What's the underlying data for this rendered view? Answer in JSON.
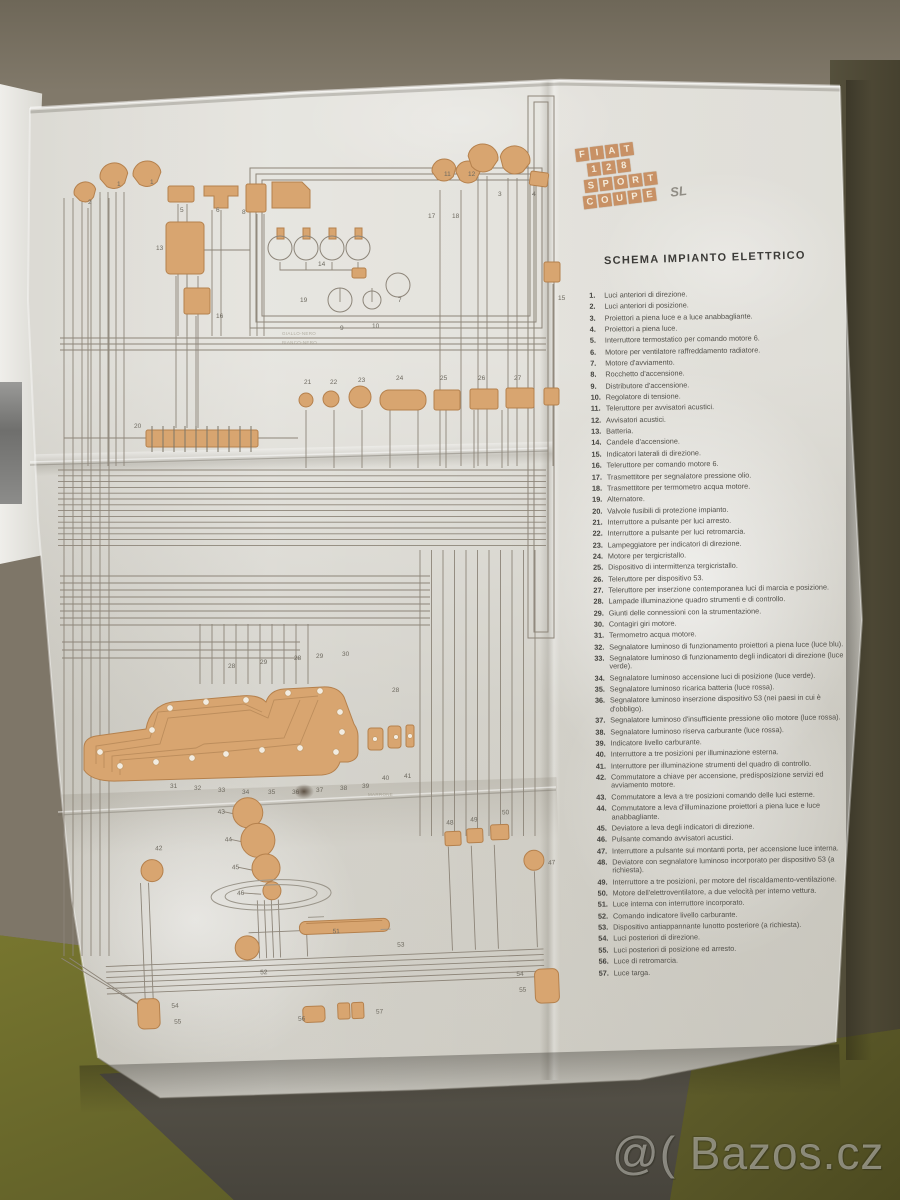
{
  "photo": {
    "watermark": "@( Bazos.cz"
  },
  "document": {
    "logo": {
      "rows": [
        "FIAT",
        "128",
        "SPORT",
        "COUPE"
      ],
      "suffix": "SL"
    },
    "title": "SCHEMA IMPIANTO ELETTRICO",
    "colors": {
      "component": "#d8a570",
      "component_stroke": "#b5814d",
      "wire": "#8d8579",
      "paper": "#d9d7cf",
      "logo_tile": "#c89165"
    },
    "legend_items": [
      {
        "n": "1.",
        "text": "Luci anteriori di direzione."
      },
      {
        "n": "2.",
        "text": "Luci anteriori di posizione."
      },
      {
        "n": "3.",
        "text": "Proiettori a piena luce e a luce anabbagliante."
      },
      {
        "n": "4.",
        "text": "Proiettori a piena luce."
      },
      {
        "n": "5.",
        "text": "Interruttore termostatico per comando motore 6."
      },
      {
        "n": "6.",
        "text": "Motore per ventilatore raffreddamento radiatore."
      },
      {
        "n": "7.",
        "text": "Motore d'avviamento."
      },
      {
        "n": "8.",
        "text": "Rocchetto d'accensione."
      },
      {
        "n": "9.",
        "text": "Distributore d'accensione."
      },
      {
        "n": "10.",
        "text": "Regolatore di tensione."
      },
      {
        "n": "11.",
        "text": "Teleruttore per avvisatori acustici."
      },
      {
        "n": "12.",
        "text": "Avvisatori acustici."
      },
      {
        "n": "13.",
        "text": "Batteria."
      },
      {
        "n": "14.",
        "text": "Candele d'accensione."
      },
      {
        "n": "15.",
        "text": "Indicatori laterali di direzione."
      },
      {
        "n": "16.",
        "text": "Teleruttore per comando motore 6."
      },
      {
        "n": "17.",
        "text": "Trasmettitore per segnalatore pressione olio."
      },
      {
        "n": "18.",
        "text": "Trasmettitore per termometro acqua motore."
      },
      {
        "n": "19.",
        "text": "Alternatore."
      },
      {
        "n": "20.",
        "text": "Valvole fusibili di protezione impianto."
      },
      {
        "n": "21.",
        "text": "Interruttore a pulsante per luci arresto."
      },
      {
        "n": "22.",
        "text": "Interruttore a pulsante per luci retromarcia."
      },
      {
        "n": "23.",
        "text": "Lampeggiatore per indicatori di direzione."
      },
      {
        "n": "24.",
        "text": "Motore per tergicristallo."
      },
      {
        "n": "25.",
        "text": "Dispositivo di intermittenza tergicristallo."
      },
      {
        "n": "26.",
        "text": "Teleruttore per dispositivo 53."
      },
      {
        "n": "27.",
        "text": "Teleruttore per inserzione contemporanea luci di marcia e posizione."
      },
      {
        "n": "28.",
        "text": "Lampade illuminazione quadro strumenti e di controllo."
      },
      {
        "n": "29.",
        "text": "Giunti delle connessioni con la strumentazione."
      },
      {
        "n": "30.",
        "text": "Contagiri giri motore."
      },
      {
        "n": "31.",
        "text": "Termometro acqua motore."
      },
      {
        "n": "32.",
        "text": "Segnalatore luminoso di funzionamento proiettori a piena luce (luce blu)."
      },
      {
        "n": "33.",
        "text": "Segnalatore luminoso di funzionamento degli indicatori di direzione (luce verde)."
      },
      {
        "n": "34.",
        "text": "Segnalatore luminoso accensione luci di posizione (luce verde)."
      },
      {
        "n": "35.",
        "text": "Segnalatore luminoso ricarica batteria (luce rossa)."
      },
      {
        "n": "36.",
        "text": "Segnalatore luminoso inserzione dispositivo 53 (nei paesi in cui è d'obbligo)."
      },
      {
        "n": "37.",
        "text": "Segnalatore luminoso d'insufficiente pressione olio motore (luce rossa)."
      },
      {
        "n": "38.",
        "text": "Segnalatore luminoso riserva carburante (luce rossa)."
      },
      {
        "n": "39.",
        "text": "Indicatore livello carburante."
      },
      {
        "n": "40.",
        "text": "Interruttore a tre posizioni per illuminazione esterna."
      },
      {
        "n": "41.",
        "text": "Interruttore per illuminazione strumenti del quadro di controllo."
      },
      {
        "n": "42.",
        "text": "Commutatore a chiave per accensione, predisposizione servizi ed avviamento motore."
      },
      {
        "n": "43.",
        "text": "Commutatore a leva a tre posizioni comando delle luci esterne."
      },
      {
        "n": "44.",
        "text": "Commutatore a leva d'illuminazione proiettori a piena luce e luce anabbagliante."
      },
      {
        "n": "45.",
        "text": "Deviatore a leva degli indicatori di direzione."
      },
      {
        "n": "46.",
        "text": "Pulsante comando avvisatori acustici."
      },
      {
        "n": "47.",
        "text": "Interruttore a pulsante sui montanti porta, per accensione luce interna."
      },
      {
        "n": "48.",
        "text": "Deviatore con segnalatore luminoso incorporato per dispositivo 53 (a richiesta)."
      },
      {
        "n": "49.",
        "text": "Interruttore a tre posizioni, per motore del riscaldamento-ventilazione."
      },
      {
        "n": "50.",
        "text": "Motore dell'elettroventilatore, a due velocità per interno vettura."
      },
      {
        "n": "51.",
        "text": "Luce interna con interruttore incorporato."
      },
      {
        "n": "52.",
        "text": "Comando indicatore livello carburante."
      },
      {
        "n": "53.",
        "text": "Dispositivo antiappannante lunotto posteriore (a richiesta)."
      },
      {
        "n": "54.",
        "text": "Luci posteriori di direzione."
      },
      {
        "n": "55.",
        "text": "Luci posteriori di posizione ed arresto."
      },
      {
        "n": "56.",
        "text": "Luce di retromarcia."
      },
      {
        "n": "57.",
        "text": "Luce targa."
      }
    ],
    "diagram_labels": [
      {
        "t": "1",
        "x": 117,
        "y": 186,
        "g": "t"
      },
      {
        "t": "1",
        "x": 150,
        "y": 184,
        "g": "t"
      },
      {
        "t": "2",
        "x": 88,
        "y": 204,
        "g": "t"
      },
      {
        "t": "5",
        "x": 180,
        "y": 212,
        "g": "t"
      },
      {
        "t": "6",
        "x": 216,
        "y": 212,
        "g": "t"
      },
      {
        "t": "13",
        "x": 156,
        "y": 250,
        "g": "t"
      },
      {
        "t": "16",
        "x": 216,
        "y": 318,
        "g": "t"
      },
      {
        "t": "8",
        "x": 242,
        "y": 214,
        "g": "t"
      },
      {
        "t": "14",
        "x": 318,
        "y": 266,
        "g": "t"
      },
      {
        "t": "9",
        "x": 340,
        "y": 330,
        "g": "t"
      },
      {
        "t": "10",
        "x": 372,
        "y": 328,
        "g": "t"
      },
      {
        "t": "11",
        "x": 444,
        "y": 176,
        "g": "t"
      },
      {
        "t": "12",
        "x": 468,
        "y": 176,
        "g": "t"
      },
      {
        "t": "3",
        "x": 498,
        "y": 196,
        "g": "t"
      },
      {
        "t": "4",
        "x": 532,
        "y": 196,
        "g": "t"
      },
      {
        "t": "7",
        "x": 398,
        "y": 302,
        "g": "t"
      },
      {
        "t": "19",
        "x": 300,
        "y": 302,
        "g": "t"
      },
      {
        "t": "15",
        "x": 558,
        "y": 300,
        "g": "t"
      },
      {
        "t": "17",
        "x": 428,
        "y": 218,
        "g": "t"
      },
      {
        "t": "18",
        "x": 452,
        "y": 218,
        "g": "t"
      },
      {
        "t": "20",
        "x": 134,
        "y": 428,
        "g": "t"
      },
      {
        "t": "21",
        "x": 304,
        "y": 384,
        "g": "t"
      },
      {
        "t": "22",
        "x": 330,
        "y": 384,
        "g": "t"
      },
      {
        "t": "23",
        "x": 358,
        "y": 382,
        "g": "t"
      },
      {
        "t": "24",
        "x": 396,
        "y": 380,
        "g": "t"
      },
      {
        "t": "25",
        "x": 440,
        "y": 380,
        "g": "t"
      },
      {
        "t": "26",
        "x": 478,
        "y": 380,
        "g": "t"
      },
      {
        "t": "27",
        "x": 514,
        "y": 380,
        "g": "t"
      },
      {
        "t": "28",
        "x": 228,
        "y": 668,
        "g": "t"
      },
      {
        "t": "29",
        "x": 260,
        "y": 664,
        "g": "t"
      },
      {
        "t": "28",
        "x": 294,
        "y": 660,
        "g": "t"
      },
      {
        "t": "29",
        "x": 316,
        "y": 658,
        "g": "t"
      },
      {
        "t": "30",
        "x": 342,
        "y": 656,
        "g": "t"
      },
      {
        "t": "28",
        "x": 392,
        "y": 692,
        "g": "t"
      },
      {
        "t": "31",
        "x": 170,
        "y": 788,
        "g": "t"
      },
      {
        "t": "32",
        "x": 194,
        "y": 790,
        "g": "t"
      },
      {
        "t": "33",
        "x": 218,
        "y": 792,
        "g": "t"
      },
      {
        "t": "34",
        "x": 242,
        "y": 794,
        "g": "t"
      },
      {
        "t": "35",
        "x": 268,
        "y": 794,
        "g": "t"
      },
      {
        "t": "36",
        "x": 292,
        "y": 794,
        "g": "t"
      },
      {
        "t": "37",
        "x": 316,
        "y": 792,
        "g": "t"
      },
      {
        "t": "38",
        "x": 340,
        "y": 790,
        "g": "t"
      },
      {
        "t": "39",
        "x": 362,
        "y": 788,
        "g": "t"
      },
      {
        "t": "40",
        "x": 382,
        "y": 780,
        "g": "t"
      },
      {
        "t": "41",
        "x": 404,
        "y": 778,
        "g": "t"
      },
      {
        "t": "42",
        "x": 162,
        "y": 852,
        "g": "b"
      },
      {
        "t": "43",
        "x": 226,
        "y": 818,
        "g": "b"
      },
      {
        "t": "44",
        "x": 232,
        "y": 846,
        "g": "b"
      },
      {
        "t": "45",
        "x": 238,
        "y": 874,
        "g": "b"
      },
      {
        "t": "46",
        "x": 242,
        "y": 900,
        "g": "b"
      },
      {
        "t": "47",
        "x": 554,
        "y": 882,
        "g": "b"
      },
      {
        "t": "48",
        "x": 454,
        "y": 838,
        "g": "b"
      },
      {
        "t": "49",
        "x": 478,
        "y": 836,
        "g": "b"
      },
      {
        "t": "50",
        "x": 510,
        "y": 830,
        "g": "b"
      },
      {
        "t": "51",
        "x": 336,
        "y": 942,
        "g": "b"
      },
      {
        "t": "52",
        "x": 262,
        "y": 980,
        "g": "b"
      },
      {
        "t": "53",
        "x": 400,
        "y": 958,
        "g": "b"
      },
      {
        "t": "54",
        "x": 172,
        "y": 1010,
        "g": "b"
      },
      {
        "t": "55",
        "x": 174,
        "y": 1026,
        "g": "b"
      },
      {
        "t": "56",
        "x": 298,
        "y": 1028,
        "g": "b"
      },
      {
        "t": "57",
        "x": 376,
        "y": 1024,
        "g": "b"
      },
      {
        "t": "54",
        "x": 518,
        "y": 992,
        "g": "b"
      },
      {
        "t": "55",
        "x": 520,
        "y": 1008,
        "g": "b"
      }
    ],
    "wire_labels": [
      {
        "t": "GIALLO-NERO",
        "x": 282,
        "y": 335
      },
      {
        "t": "BIANCO-NERO",
        "x": 282,
        "y": 344
      },
      {
        "t": "MARRONE",
        "x": 368,
        "y": 796
      }
    ]
  }
}
